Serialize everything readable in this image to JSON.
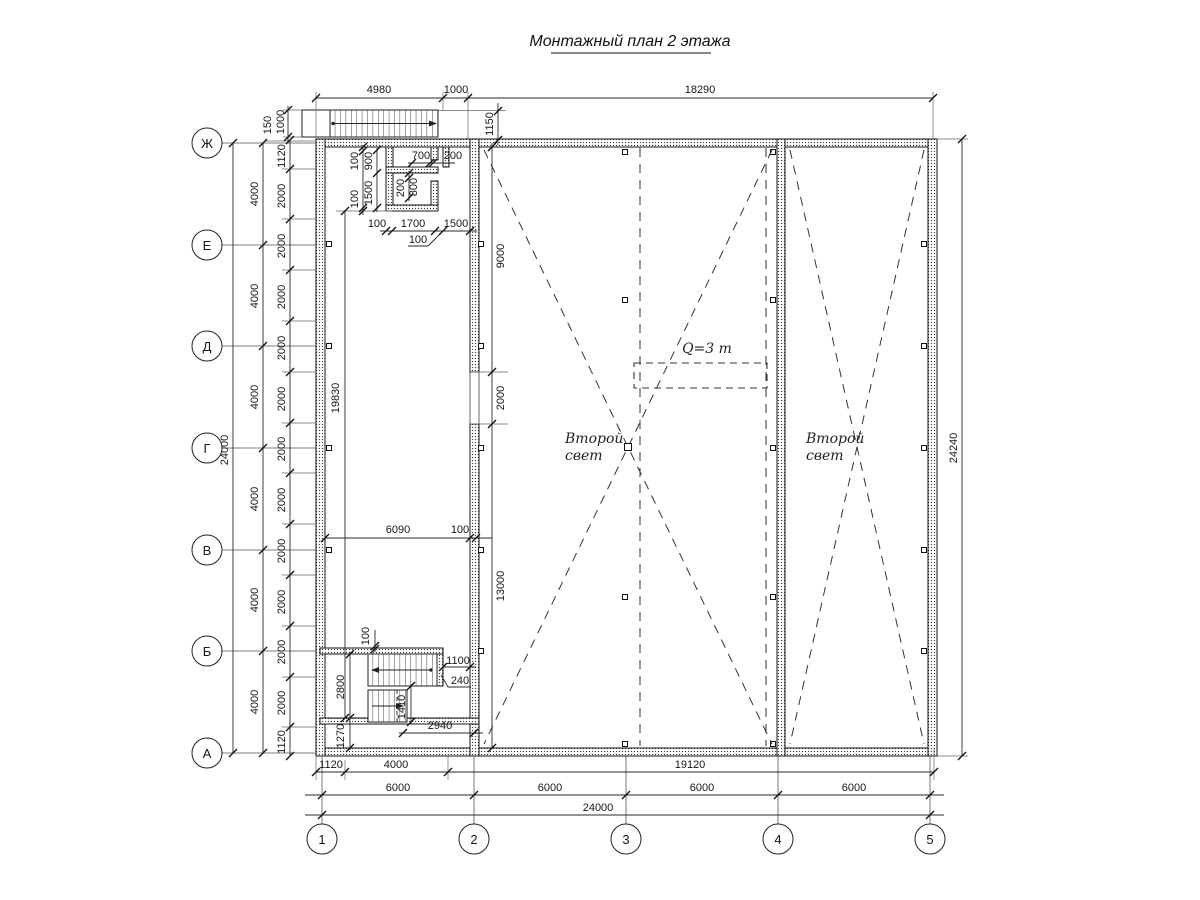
{
  "title": "Монтажный план 2 этажа",
  "annotations": {
    "crane": "Q=3 т",
    "void_left_line1": "Второй",
    "void_left_line2": "свет",
    "void_right_line1": "Второй",
    "void_right_line2": "свет"
  },
  "axes": {
    "cols": [
      "1",
      "2",
      "3",
      "4",
      "5"
    ],
    "rows": [
      "Ж",
      "Е",
      "Д",
      "Г",
      "В",
      "Б",
      "А"
    ]
  },
  "dims": {
    "top_4980": "4980",
    "top_1000": "1000",
    "top_18290": "18290",
    "stair_150": "150",
    "stair_1000": "1000",
    "wall_1150": "1150",
    "left_24000": "24000",
    "left_4000": "4000",
    "left_2000": "2000",
    "left_1120": "1120",
    "right_24240": "24240",
    "room_100": "100",
    "room_900": "900",
    "room_1500": "1500",
    "room_700": "700",
    "room_200": "200",
    "room_800": "800",
    "room_1700": "1700",
    "mid_19830": "19830",
    "mid_9000": "9000",
    "mid_2000": "2000",
    "mid_13000": "13000",
    "mid_6090": "6090",
    "mid_100": "100",
    "st_100": "100",
    "st_2800": "2800",
    "st_1270": "1270",
    "st_1100": "1100",
    "st_240": "240",
    "st_1410": "1410",
    "st_2940": "2940",
    "bot_1120": "1120",
    "bot_4000": "4000",
    "bot_19120": "19120",
    "bot_6000": "6000",
    "bot_24000": "24000"
  }
}
